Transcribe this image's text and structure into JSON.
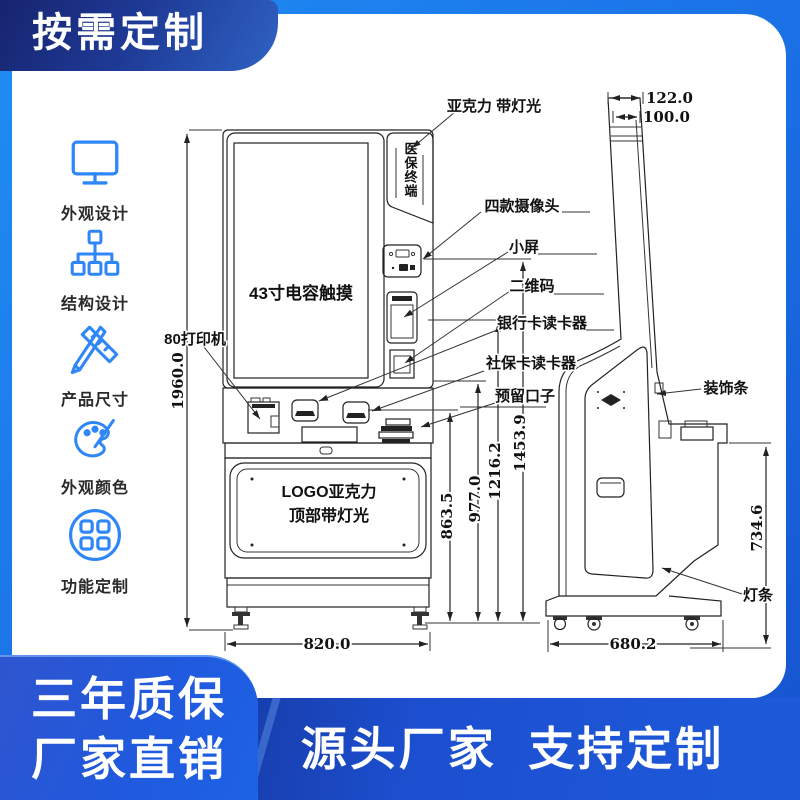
{
  "colors": {
    "bg-blue-light": "#1F8EF4",
    "bg-blue-mid": "#1B74E8",
    "bg-blue-deep": "#1653CE",
    "banner-navy": "#17246F",
    "accent": "#2F86F6"
  },
  "banners": {
    "top_left": "按需定制",
    "bottom_left": [
      "三年质保",
      "厂家直销"
    ],
    "bottom_bar": "源头厂家  支持定制"
  },
  "sidebar": {
    "items": [
      {
        "icon": "monitor-icon",
        "label": "外观设计"
      },
      {
        "icon": "structure-icon",
        "label": "结构设计"
      },
      {
        "icon": "pencil-ruler-icon",
        "label": "产品尺寸"
      },
      {
        "icon": "palette-icon",
        "label": "外观颜色"
      },
      {
        "icon": "grid-circle-icon",
        "label": "功能定制"
      }
    ]
  },
  "diagram": {
    "labels": {
      "acrylic": "亚克力 带灯光",
      "sign_vertical": "医保终端",
      "cameras": "四款摄像头",
      "small_screen": "小屏",
      "qr": "二维码",
      "bank_reader": "银行卡读卡器",
      "social_reader": "社保卡读卡器",
      "reserved": "预留口子",
      "touch": "43寸电容触摸",
      "printer": "80打印机",
      "logo1": "LOGO亚克力",
      "logo2": "顶部带灯光",
      "decor": "装饰条",
      "light": "灯条"
    },
    "dims": {
      "total_height": "1960.0",
      "front_width": "820.0",
      "depth": "680.2",
      "pole_top_outer": "122.0",
      "pole_top_inner": "100.0",
      "h_social": "863.5",
      "h_mid": "977.0",
      "h_qr": "1216.2",
      "h_screen": "1453.9",
      "side_back": "734.6"
    }
  }
}
